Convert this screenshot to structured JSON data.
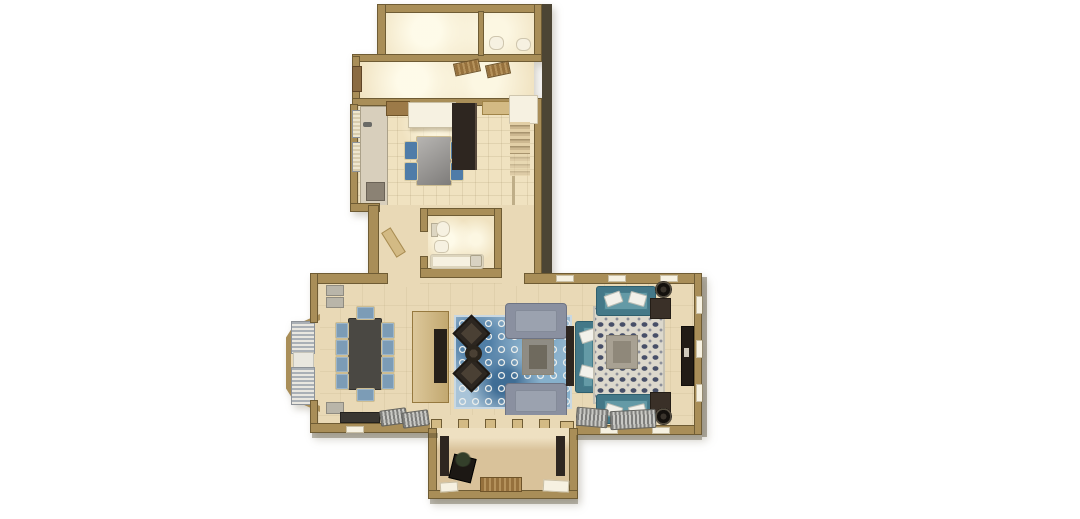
{
  "meta": {
    "title": "Top-down 3D render of an L-shaped ground-floor plan",
    "canvas": {
      "width": 1080,
      "height": 519
    }
  },
  "colors": {
    "background": "#ffffff",
    "wall": "#a98e58",
    "wall_edge": "#6f5c34",
    "wall_shadow": "#4c4534",
    "floor": "#e9d9b6",
    "floor_bright": "#f0e2c0",
    "floor_porch": "#d9c29a",
    "counter": "#d8cfbc",
    "cabinet_tan": "#d3ba84",
    "wood_brown": "#9c7a48",
    "wood_dark": "#2e2620",
    "white_fixture": "#f6f1e1",
    "chair_blue": "#7c9cb6",
    "kitchen_chair_blue": "#4f7ca8",
    "dining_table": "#4a4843",
    "sofa_gray": "#8a90a0",
    "sofa_gray_trim": "#6e7484",
    "sofa_teal": "#447888",
    "sofa_teal_light": "#649aa6",
    "rug_blue_base": "#a9c4d8",
    "rug_blue_ring": "#e9ecea",
    "rug_blue_deep": "#4f7ea6",
    "rug_navy_base": "#dcd8cc",
    "rug_navy_motif": "#474f68",
    "mat_brown": "#96713d",
    "stripe_dark": "#7e7e7c",
    "stripe_light": "#c9c9c5",
    "curtain_gray": "#aab0b6",
    "curtain_white": "#e9e7e0",
    "plant_green": "#333f2a",
    "radiator_gray": "#b9b5a9",
    "table_tan": "#a8a193",
    "table_tan_dark": "#6f6a5e"
  },
  "rooms": {
    "mudroom": {
      "label": "Mudroom (top room, recessed lighting)",
      "furniture": []
    },
    "powder_room": {
      "label": "Powder room",
      "furniture": [
        "toilet",
        "sink"
      ]
    },
    "entry_hall": {
      "label": "Entry hall",
      "furniture": [
        "entry door",
        "doormat",
        "doormat"
      ]
    },
    "kitchen": {
      "label": "Kitchen",
      "furniture": [
        "counter run",
        "range",
        "white island",
        "breakfast table",
        "4 blue chairs",
        "tall pantry cabinet",
        "wall cabinets",
        "window curtains"
      ]
    },
    "stair_hall": {
      "label": "Stair hall",
      "furniture": [
        "staircase",
        "white landing",
        "railing"
      ]
    },
    "bathroom": {
      "label": "Hall bathroom",
      "furniture": [
        "toilet",
        "sink",
        "bathtub",
        "door"
      ]
    },
    "dining_room": {
      "label": "Dining room",
      "furniture": [
        "long dark dining table",
        "10 blue chairs",
        "bay window with curtains",
        "TV hutch divider",
        "sideboard",
        "2 striped benches",
        "2 radiators"
      ]
    },
    "sitting_room": {
      "label": "Sitting room",
      "furniture": [
        "blue quatrefoil rug",
        "2 gray settees",
        "coffee table",
        "2 dark armchairs",
        "round ottoman",
        "teal loveseat",
        "console table"
      ]
    },
    "family_room": {
      "label": "Family room",
      "furniture": [
        "navy patterned rug",
        "2 teal sofas",
        "coffee table",
        "2 dark side tables",
        "2 round planters",
        "media console",
        "2 striped loungers"
      ]
    },
    "porch": {
      "label": "Rear porch",
      "furniture": [
        "2 dark door posts",
        "black planter with plant",
        "wood doormat",
        "2 step mats",
        "5 door piers"
      ]
    }
  },
  "counts": {
    "dining_chairs": 10,
    "kitchen_chairs": 4,
    "gray_settees": 2,
    "teal_sofas": 3,
    "porch_piers": 5
  }
}
